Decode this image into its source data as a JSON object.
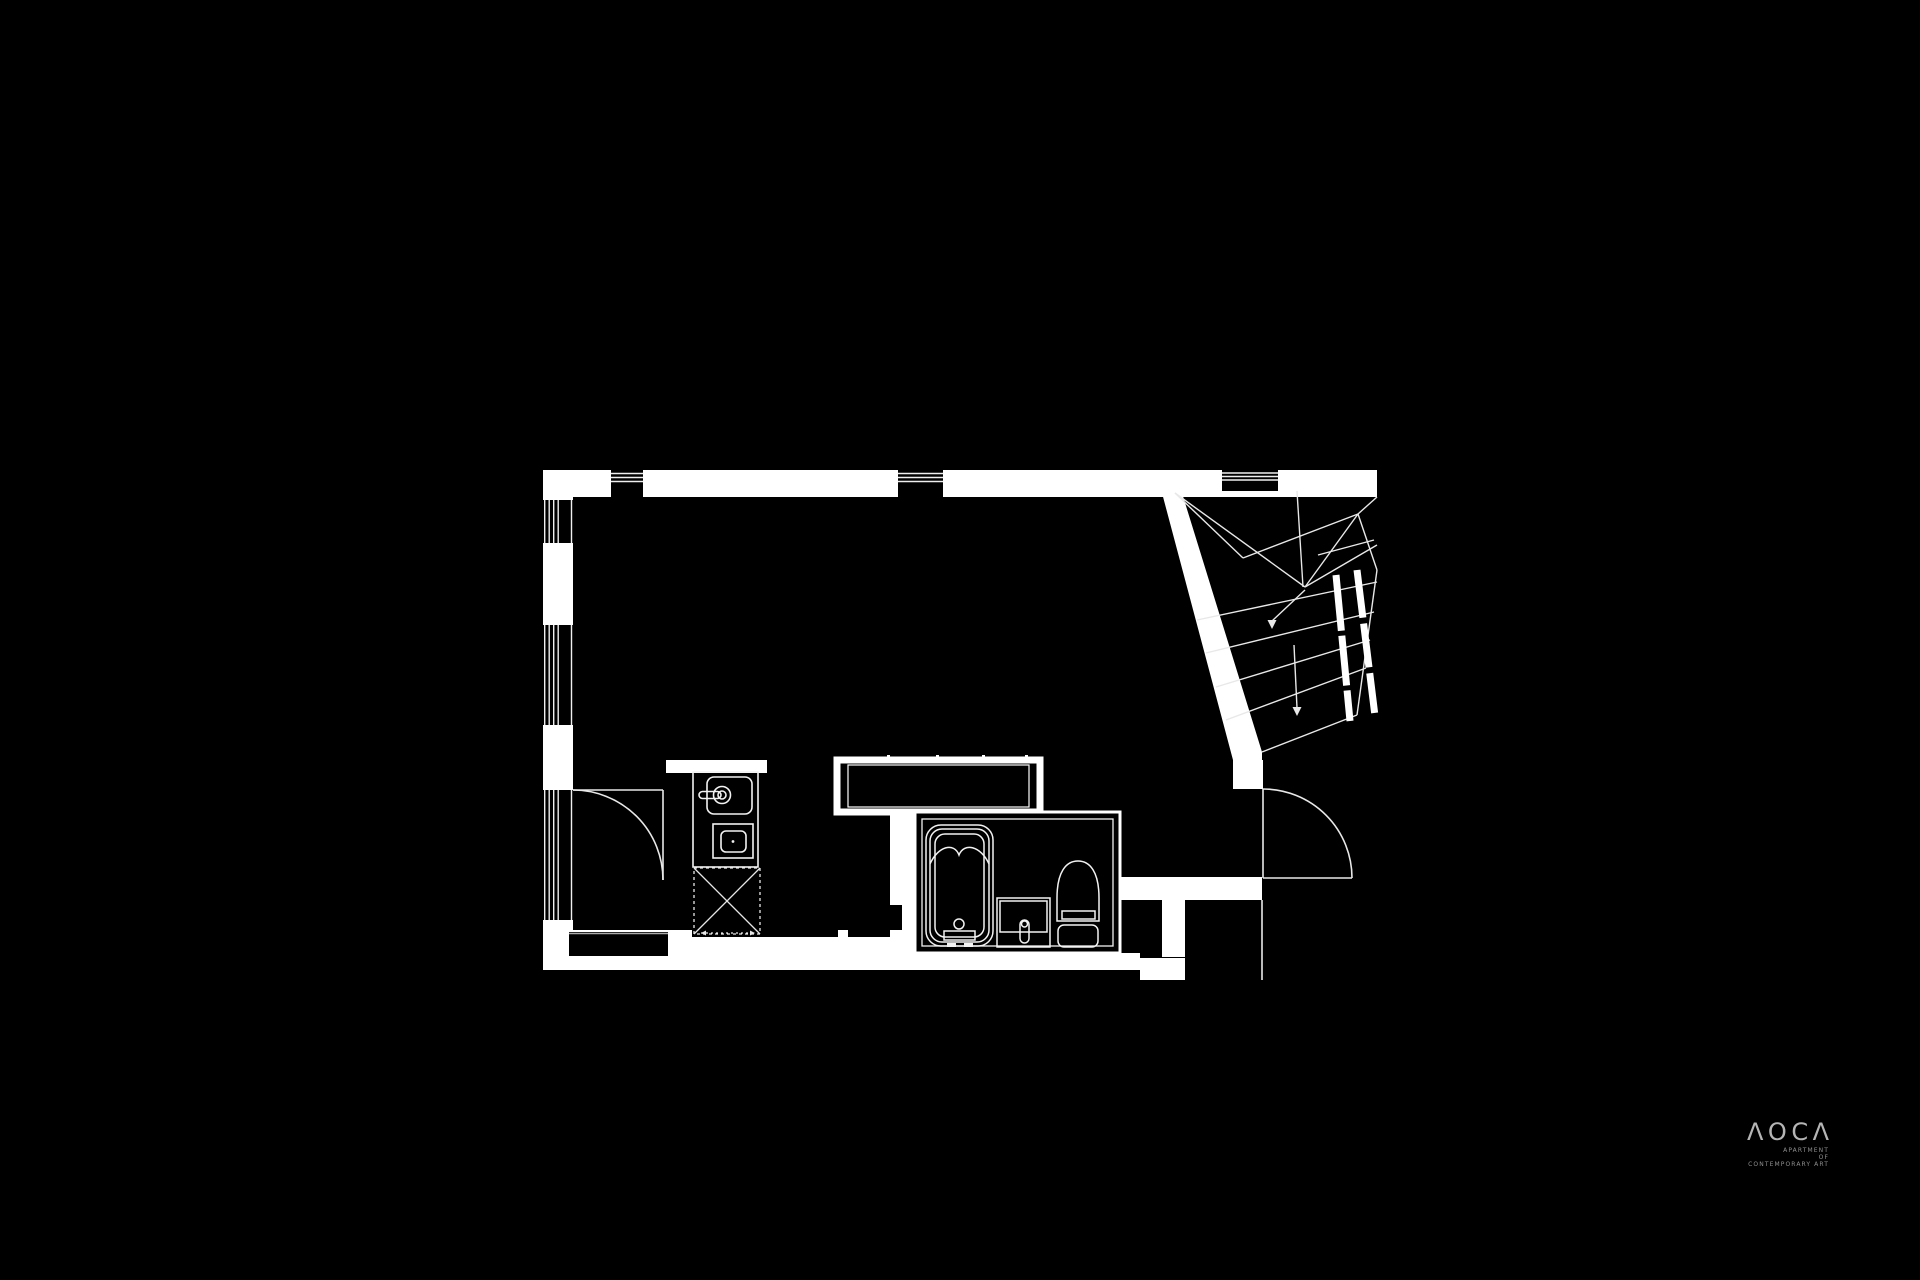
{
  "page": {
    "background_color": "#000000"
  },
  "logo": {
    "text": "AOCA",
    "display": "ΛOCΛ",
    "line1": "APARTMENT",
    "line2": "OF",
    "line3": "CONTEMPORARY ART",
    "wordmark_color": "#b5b5b5",
    "subtext_color": "#8f8f8f"
  },
  "floor_plan": {
    "wall_color": "#ffffff",
    "thin_line_color": "#efefef",
    "background_color": "#000000",
    "icons": [
      "window-icon",
      "entry-door-swing-icon",
      "interior-door-swing-icon",
      "kitchen-sink-icon",
      "faucet-icon",
      "cooktop-icon",
      "refrigerator-space-icon",
      "counter-island-icon",
      "bathtub-icon",
      "vanity-sink-icon",
      "toilet-icon",
      "staircase-icon",
      "down-arrow-icon",
      "closet-icon"
    ]
  }
}
